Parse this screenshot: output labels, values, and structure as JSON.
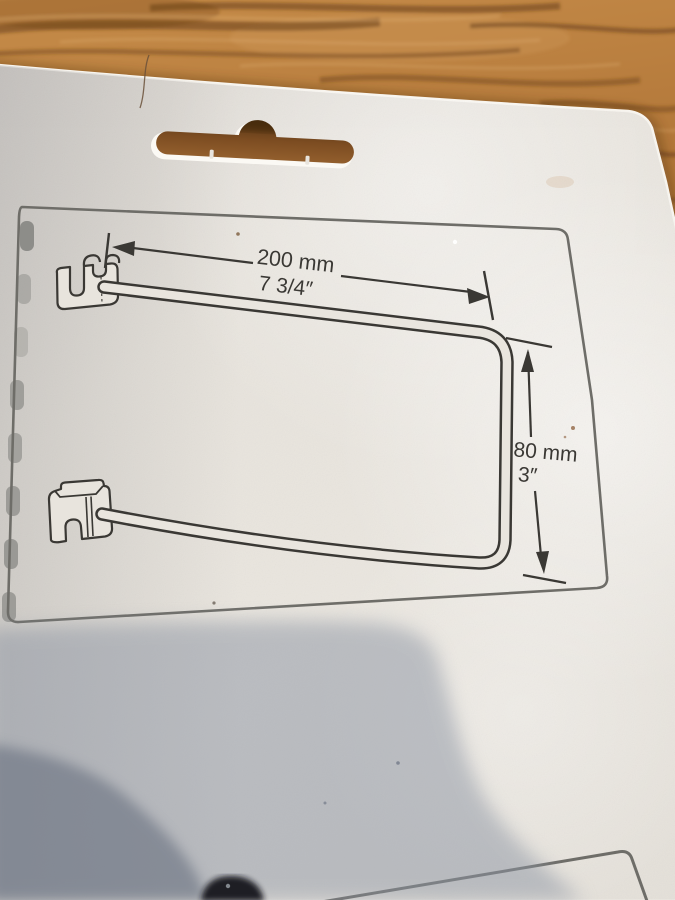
{
  "diagram": {
    "width_label_metric": "200 mm",
    "width_label_imperial": "7 3/4″",
    "height_label_metric": "80 mm",
    "height_label_imperial": "3″"
  },
  "colors": {
    "wood_base": "#b67a3c",
    "wood_dark_streak": "#6f4017",
    "card_paper": "#e8e4dd",
    "drawing_ink": "#3a3834",
    "frame_line": "#6e6d68",
    "soft_shadow": "#8c94a3",
    "deep_shadow": "#67707f",
    "silhouette": "#17181d"
  }
}
